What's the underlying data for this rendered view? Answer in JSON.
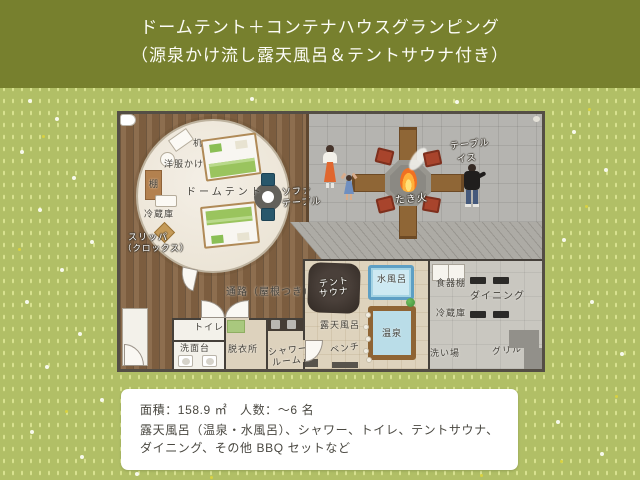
{
  "title": {
    "line1": "ドームテント＋コンテナハウスグランピング",
    "line2": "（源泉かけ流し露天風呂＆テントサウナ付き）"
  },
  "plan": {
    "dome": {
      "name": "ドームテント",
      "desk": "机",
      "hanger": "洋服かけ",
      "shelf": "棚",
      "fridge": "冷蔵庫",
      "slippers1": "スリッパ",
      "slippers2": "（クロックス）",
      "sofa1": "ソファ",
      "sofa2": "テーブル"
    },
    "fire": {
      "table": "テーブル",
      "chair": "イス",
      "bonfire": "たき火"
    },
    "corridor": {
      "passage": "通路（屋根つき）",
      "toilet": "トイレ",
      "washstand": "洗面台",
      "dressing": "脱衣所",
      "shower1": "シャワー",
      "shower2": "ルーム"
    },
    "bath": {
      "sauna1": "テント",
      "sauna2": "サウナ",
      "coldbath": "水風呂",
      "rotenburo": "露天風呂",
      "onsen": "温泉",
      "bench": "ベンチ"
    },
    "dining": {
      "cupboard": "食器棚",
      "dining": "ダイニング",
      "fridge": "冷蔵庫",
      "sink": "洗い場",
      "grill": "グリル"
    }
  },
  "info": {
    "line1": "面積：158.9 ㎡　人数：～6 名",
    "line2": "露天風呂（温泉・水風呂）、シャワー、トイレ、テントサウナ、",
    "line3": "ダイニング、その他 BBQ セットなど"
  },
  "colors": {
    "banner": "#77802e",
    "grass": "#b1bf66",
    "wood": "#866544",
    "tile": "#b5b4b0",
    "flame": "#f07022"
  }
}
